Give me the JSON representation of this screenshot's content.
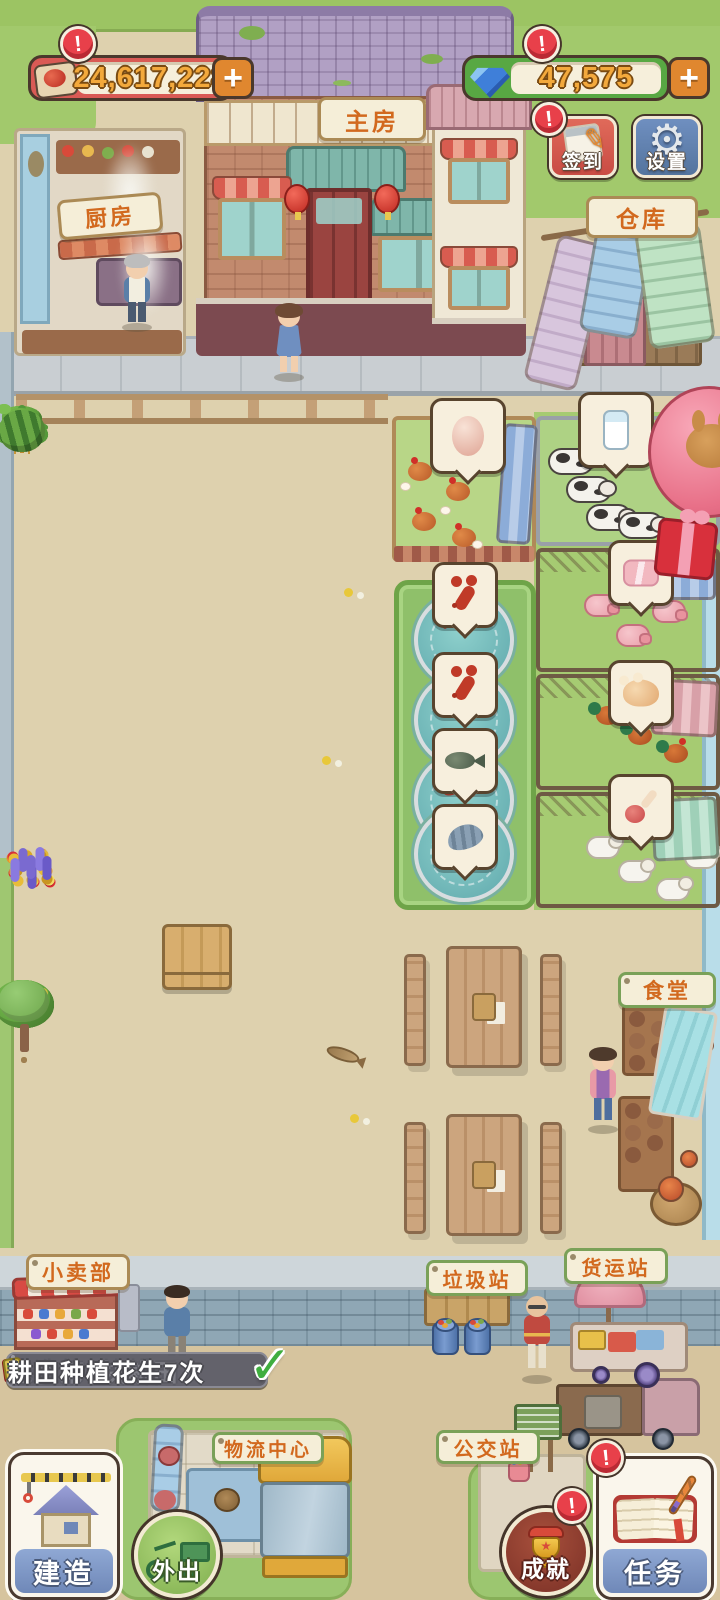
{
  "hud": {
    "food": {
      "value": "24,617,228",
      "add": "+",
      "alert": "!",
      "icon": "meat-plate-icon"
    },
    "gems": {
      "value": "47,575",
      "add": "+",
      "alert": "!",
      "icon": "gem-icon"
    },
    "signin": {
      "label": "签到",
      "alert": "!",
      "icon": "notepad-pencil-icon"
    },
    "settings": {
      "label": "设置",
      "icon": "gear-icon"
    }
  },
  "signs": {
    "kitchen": "厨房",
    "main_house": "主房",
    "warehouse": "仓库",
    "canteen": "食堂",
    "shop": "小卖部",
    "garbage_station": "垃圾站",
    "freight_station": "货运站",
    "logistics_center": "物流中心",
    "bus_station": "公交站"
  },
  "quests": [
    {
      "text": "建造第3块耕田",
      "icon": "red-notebook-icon",
      "check": "✓"
    },
    {
      "text": "耕田种植花生7次",
      "icon": "seed-bag-icon",
      "check": ""
    }
  ],
  "actions": {
    "build": {
      "label": "建造",
      "icon": "construction-house-icon"
    },
    "go_out": {
      "label": "外出",
      "icon": "cargo-tricycle-icon"
    },
    "achievements": {
      "label": "成就",
      "alert": "!",
      "icon": "trophy-icon"
    },
    "tasks": {
      "label": "任务",
      "alert": "!",
      "icon": "book-pen-icon"
    }
  },
  "farm": {
    "crops": [
      "tomato",
      "seedling",
      "seedling",
      "seedling",
      "seedling",
      "tomato",
      "wheat",
      "wheat",
      "tomato",
      "seedling",
      "seedling",
      "sweet-potato",
      "strawberry",
      "sweet-potato",
      "sweet-potato",
      "strawberry",
      "strawberry",
      "strawberry",
      "sweet-potato",
      "turnip",
      "strawberry",
      "watermelon",
      "watermelon",
      "watermelon"
    ],
    "flowers": [
      "tulip",
      "rose",
      "lily",
      "yellow-rose",
      "marigold",
      "lavender"
    ],
    "trees": [
      "orange",
      "persimmon",
      "peach",
      "plum",
      "apple",
      "cherry",
      "pear",
      "sapling"
    ],
    "production_bubbles": [
      "egg",
      "milk",
      "crayfish",
      "crayfish",
      "fish",
      "shrimp",
      "pork",
      "chicken",
      "lamb-leg"
    ]
  },
  "colors": {
    "accent_red": "#d95a55",
    "accent_green": "#58a843",
    "gold_text": "#f3a93c",
    "plaque_text": "#d2691e"
  }
}
